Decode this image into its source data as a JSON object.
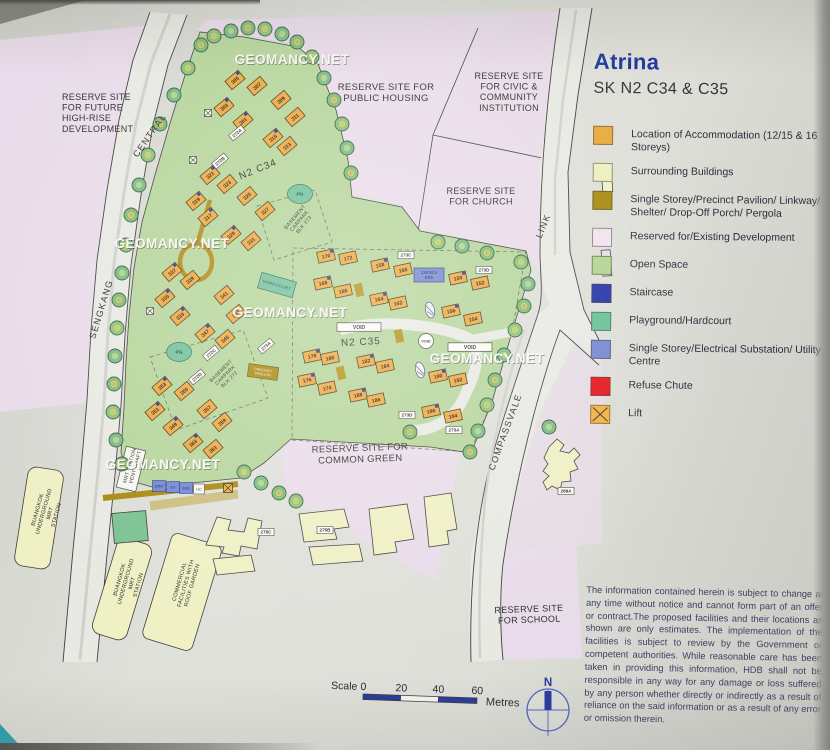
{
  "page": {
    "watermark": "GEOMANCY.NET"
  },
  "legend": {
    "title": "Atrina",
    "subtitle": "SK N2 C34 & C35",
    "items": [
      {
        "label": "Location of Accommodation (12/15 & 16 Storeys)",
        "color": "#e9a93c",
        "style": "solid"
      },
      {
        "label": "Surrounding Buildings",
        "color": "#edefbe",
        "style": "solid"
      },
      {
        "label": "Single Storey/Precinct Pavilion/ Linkway/ Shelter/ Drop-Off Porch/ Pergola",
        "color": "#a8890f",
        "style": "solid"
      },
      {
        "label": "Reserved for/Existing Development",
        "color": "#f2e3ee",
        "style": "solid"
      },
      {
        "label": "Open Space",
        "color": "#b2d591",
        "style": "solid"
      },
      {
        "label": "Staircase",
        "color": "#2433a5",
        "style": "solid"
      },
      {
        "label": "Playground/Hardcourt",
        "color": "#66c196",
        "style": "solid"
      },
      {
        "label": "Single Storey/Electrical Substation/ Utility Centre",
        "color": "#7488d2",
        "style": "solid"
      },
      {
        "label": "Refuse Chute",
        "color": "#e6151d",
        "style": "solid"
      },
      {
        "label": "Lift",
        "color": "#f2b13e",
        "style": "cross"
      }
    ],
    "disclaimer": "The information contained herein is subject to change at any time without notice and cannot form part of an offer or contract.The proposed facilities and their locations as shown are only estimates. The implementation of the facilities is subject to review by the Government or competent authorities. While reasonable care has been taken in providing this information, HDB shall not be responsible in any way for any damage or loss suffered by any person whether directly or indirectly as a result of reliance on the said information or as a result of any error or omission therein."
  },
  "scalebar": {
    "label": "Scale",
    "ticks": [
      "0",
      "20",
      "40",
      "60"
    ],
    "unit": "Metres",
    "north": "N"
  },
  "map": {
    "area_labels": [
      {
        "id": "reserve-future",
        "lines": [
          "RESERVE SITE",
          "FOR FUTURE",
          "HIGH-RISE",
          "DEVELOPMENT"
        ],
        "x": 62,
        "y": 100,
        "size": 9,
        "anchor": "start",
        "rot": 0
      },
      {
        "id": "reserve-public",
        "lines": [
          "RESERVE SITE FOR",
          "PUBLIC HOUSING"
        ],
        "x": 386,
        "y": 90,
        "size": 9.5,
        "anchor": "middle",
        "rot": 0
      },
      {
        "id": "reserve-civic",
        "lines": [
          "RESERVE SITE",
          "FOR CIVIC &",
          "COMMUNITY",
          "INSTITUTION"
        ],
        "x": 509,
        "y": 79,
        "size": 9,
        "anchor": "middle",
        "rot": 0
      },
      {
        "id": "reserve-church",
        "lines": [
          "RESERVE SITE",
          "FOR CHURCH"
        ],
        "x": 481,
        "y": 194,
        "size": 9,
        "anchor": "middle",
        "rot": 0
      },
      {
        "id": "reserve-common",
        "lines": [
          "RESERVE SITE FOR",
          "COMMON GREEN"
        ],
        "x": 360,
        "y": 451,
        "size": 9.5,
        "anchor": "middle",
        "rot": -2
      },
      {
        "id": "reserve-school",
        "lines": [
          "RESERVE SITE",
          "FOR SCHOOL"
        ],
        "x": 529,
        "y": 612,
        "size": 9,
        "anchor": "middle",
        "rot": -2
      },
      {
        "id": "cluster-n2c34",
        "lines": [
          "N2 C34"
        ],
        "x": 259,
        "y": 172,
        "size": 10,
        "anchor": "middle",
        "rot": -22
      },
      {
        "id": "cluster-n2c35",
        "lines": [
          "N2 C35"
        ],
        "x": 361,
        "y": 345,
        "size": 10,
        "anchor": "middle",
        "rot": -3
      },
      {
        "id": "basement-273",
        "lines": [
          "BASEMENT",
          "CARPARK",
          "BLK 273"
        ],
        "x": 296,
        "y": 218,
        "size": 5,
        "anchor": "middle",
        "rot": -50
      },
      {
        "id": "basement-272",
        "lines": [
          "BASEMENT",
          "CARPARK",
          "BLK 272"
        ],
        "x": 222,
        "y": 372,
        "size": 5,
        "anchor": "middle",
        "rot": -45
      },
      {
        "id": "mrt-vent",
        "lines": [
          "MRT STATION",
          "VENT SHAFT"
        ],
        "x": 131,
        "y": 466,
        "size": 5,
        "anchor": "middle",
        "rot": -74
      },
      {
        "id": "buangkok-mrt-1",
        "lines": [
          "BUANGKOK",
          "UNDERGROUND",
          "MRT",
          "STATION"
        ],
        "x": 39,
        "y": 510,
        "size": 5.5,
        "anchor": "middle",
        "rot": -74
      },
      {
        "id": "buangkok-mrt-2",
        "lines": [
          "BUANGKOK",
          "UNDERGROUND",
          "MRT",
          "STATION"
        ],
        "x": 121,
        "y": 580,
        "size": 5.5,
        "anchor": "middle",
        "rot": -74
      },
      {
        "id": "commercial",
        "lines": [
          "COMMERCIAL",
          "FACILITIES WITH",
          "ROOF GARDEN"
        ],
        "x": 181,
        "y": 582,
        "size": 5.5,
        "anchor": "middle",
        "rot": -74
      }
    ],
    "road_labels": [
      {
        "text": "CENTRAL",
        "x": 152,
        "y": 137,
        "rot": -55
      },
      {
        "text": "SENGKANG",
        "x": 104,
        "y": 310,
        "rot": -73
      },
      {
        "text": "LINK",
        "x": 546,
        "y": 227,
        "rot": -68
      },
      {
        "text": "COMPASSVALE",
        "x": 508,
        "y": 433,
        "rot": -70
      }
    ],
    "blocks": [
      {
        "n": "305",
        "x": 235,
        "y": 80,
        "r": -40
      },
      {
        "n": "307",
        "x": 257,
        "y": 86,
        "r": -40
      },
      {
        "n": "303",
        "x": 224,
        "y": 107,
        "r": -40
      },
      {
        "n": "309",
        "x": 281,
        "y": 100,
        "r": -40
      },
      {
        "n": "301",
        "x": 243,
        "y": 121,
        "r": -40
      },
      {
        "n": "311",
        "x": 295,
        "y": 117,
        "r": -40
      },
      {
        "n": "315",
        "x": 273,
        "y": 138,
        "r": -40
      },
      {
        "n": "313",
        "x": 287,
        "y": 146,
        "r": -40
      },
      {
        "n": "321",
        "x": 210,
        "y": 175,
        "r": -40
      },
      {
        "n": "323",
        "x": 227,
        "y": 184,
        "r": -40
      },
      {
        "n": "319",
        "x": 196,
        "y": 201,
        "r": -40
      },
      {
        "n": "325",
        "x": 247,
        "y": 196,
        "r": -40
      },
      {
        "n": "317",
        "x": 208,
        "y": 217,
        "r": -40
      },
      {
        "n": "327",
        "x": 265,
        "y": 211,
        "r": -40
      },
      {
        "n": "329",
        "x": 231,
        "y": 235,
        "r": -40
      },
      {
        "n": "331",
        "x": 251,
        "y": 241,
        "r": -40
      },
      {
        "n": "337",
        "x": 172,
        "y": 272,
        "r": -40
      },
      {
        "n": "339",
        "x": 190,
        "y": 280,
        "r": -40
      },
      {
        "n": "335",
        "x": 165,
        "y": 298,
        "r": -40
      },
      {
        "n": "341",
        "x": 224,
        "y": 295,
        "r": -40
      },
      {
        "n": "333",
        "x": 180,
        "y": 316,
        "r": -40
      },
      {
        "n": "343",
        "x": 236,
        "y": 314,
        "r": -40
      },
      {
        "n": "347",
        "x": 205,
        "y": 333,
        "r": -40
      },
      {
        "n": "345",
        "x": 225,
        "y": 339,
        "r": -40
      },
      {
        "n": "353",
        "x": 162,
        "y": 386,
        "r": -40
      },
      {
        "n": "355",
        "x": 184,
        "y": 391,
        "r": -40
      },
      {
        "n": "351",
        "x": 155,
        "y": 411,
        "r": -40
      },
      {
        "n": "357",
        "x": 207,
        "y": 409,
        "r": -40
      },
      {
        "n": "349",
        "x": 173,
        "y": 426,
        "r": -40
      },
      {
        "n": "359",
        "x": 222,
        "y": 422,
        "r": -40
      },
      {
        "n": "363",
        "x": 193,
        "y": 443,
        "r": -40
      },
      {
        "n": "361",
        "x": 213,
        "y": 449,
        "r": -40
      },
      {
        "n": "170",
        "x": 326,
        "y": 256,
        "r": -12
      },
      {
        "n": "172",
        "x": 348,
        "y": 258,
        "r": -12
      },
      {
        "n": "158",
        "x": 380,
        "y": 265,
        "r": -12
      },
      {
        "n": "160",
        "x": 403,
        "y": 270,
        "r": -12
      },
      {
        "n": "150",
        "x": 458,
        "y": 278,
        "r": -12
      },
      {
        "n": "152",
        "x": 480,
        "y": 283,
        "r": -12
      },
      {
        "n": "168",
        "x": 323,
        "y": 283,
        "r": -12
      },
      {
        "n": "166",
        "x": 343,
        "y": 291,
        "r": -12
      },
      {
        "n": "164",
        "x": 379,
        "y": 299,
        "r": -12
      },
      {
        "n": "162",
        "x": 398,
        "y": 303,
        "r": -12
      },
      {
        "n": "156",
        "x": 451,
        "y": 311,
        "r": -12
      },
      {
        "n": "154",
        "x": 473,
        "y": 319,
        "r": -12
      },
      {
        "n": "178",
        "x": 312,
        "y": 356,
        "r": -12
      },
      {
        "n": "180",
        "x": 330,
        "y": 358,
        "r": -12
      },
      {
        "n": "182",
        "x": 366,
        "y": 361,
        "r": -12
      },
      {
        "n": "184",
        "x": 385,
        "y": 366,
        "r": -12
      },
      {
        "n": "176",
        "x": 307,
        "y": 380,
        "r": -12
      },
      {
        "n": "174",
        "x": 327,
        "y": 388,
        "r": -12
      },
      {
        "n": "188",
        "x": 358,
        "y": 395,
        "r": -12
      },
      {
        "n": "186",
        "x": 376,
        "y": 400,
        "r": -12
      },
      {
        "n": "190",
        "x": 438,
        "y": 376,
        "r": -12
      },
      {
        "n": "192",
        "x": 458,
        "y": 380,
        "r": -12
      },
      {
        "n": "196",
        "x": 431,
        "y": 411,
        "r": -12
      },
      {
        "n": "194",
        "x": 453,
        "y": 416,
        "r": -12
      }
    ],
    "chips": [
      {
        "t": "272A",
        "x": 237,
        "y": 133,
        "r": -40
      },
      {
        "t": "272B",
        "x": 220,
        "y": 161,
        "r": -40
      },
      {
        "t": "272C",
        "x": 211,
        "y": 353,
        "r": -40
      },
      {
        "t": "272D",
        "x": 197,
        "y": 377,
        "r": -40
      },
      {
        "t": "273A",
        "x": 266,
        "y": 346,
        "r": -40
      },
      {
        "t": "273C",
        "x": 406,
        "y": 255,
        "r": 0
      },
      {
        "t": "273D",
        "x": 484,
        "y": 270,
        "r": 0
      },
      {
        "t": "273D",
        "x": 407,
        "y": 415,
        "r": 0
      },
      {
        "t": "273A",
        "x": 454,
        "y": 430,
        "r": 0
      },
      {
        "t": "275C",
        "x": 266,
        "y": 532,
        "r": 0
      },
      {
        "t": "275B",
        "x": 325,
        "y": 530,
        "r": 0
      },
      {
        "t": "269A",
        "x": 566,
        "y": 491,
        "r": 0
      }
    ],
    "facilities": [
      {
        "t": "PG",
        "x": 300,
        "y": 194,
        "kind": "pg"
      },
      {
        "t": "PG",
        "x": 179,
        "y": 352,
        "kind": "pg"
      },
      {
        "t": "HARDCOURT",
        "x": 277,
        "y": 285,
        "r": -74,
        "kind": "court"
      },
      {
        "t": "PRECINCT PAVILION",
        "x": 263,
        "y": 372,
        "r": -82,
        "kind": "pavilion"
      },
      {
        "t": "VOID",
        "x": 359,
        "y": 327,
        "kind": "voidbar"
      },
      {
        "t": "VOID",
        "x": 470,
        "y": 347,
        "kind": "voidbar"
      },
      {
        "t": "VOID",
        "x": 426,
        "y": 341,
        "kind": "voidcircle"
      },
      {
        "t": "22KV/LV ESS",
        "x": 429,
        "y": 275,
        "kind": "ess"
      },
      {
        "t": "22KV",
        "x": 159,
        "y": 486,
        "kind": "essSmall"
      },
      {
        "t": "/LV",
        "x": 173,
        "y": 487,
        "kind": "essSmall"
      },
      {
        "t": "ESS",
        "x": 186,
        "y": 488,
        "kind": "essSmall"
      },
      {
        "t": "UC",
        "x": 199,
        "y": 489,
        "kind": "ucbox"
      }
    ],
    "watermarks": [
      {
        "x": 292,
        "y": 64
      },
      {
        "x": 172,
        "y": 248
      },
      {
        "x": 290,
        "y": 317
      },
      {
        "x": 487,
        "y": 363
      },
      {
        "x": 163,
        "y": 469
      }
    ]
  }
}
